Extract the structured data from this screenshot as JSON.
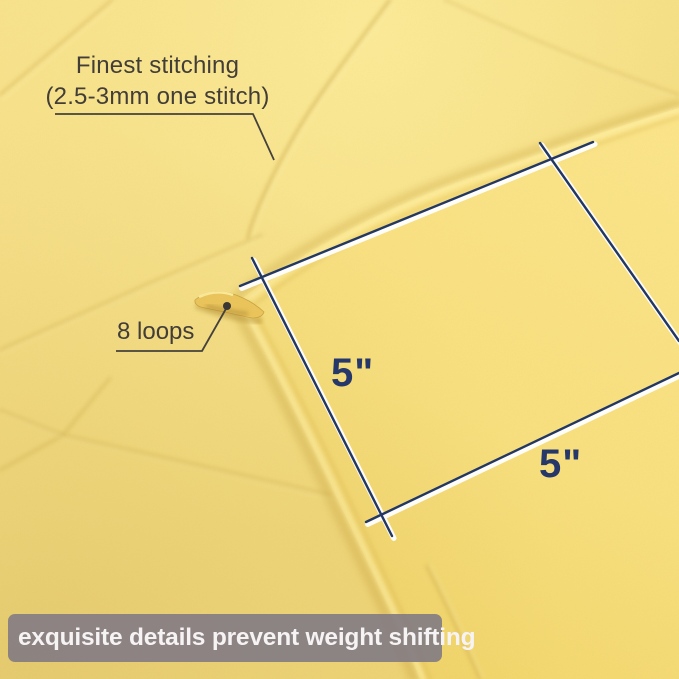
{
  "photo": {
    "subject": "yellow quilted weighted blanket corner close-up"
  },
  "annotations": {
    "stitching_line1": "Finest stitching",
    "stitching_line2": "(2.5-3mm one stitch)",
    "loops_label": "8 loops",
    "square_side_left": "5\"",
    "square_side_bottom": "5\""
  },
  "banner": {
    "text": "exquisite details prevent weight shifting"
  },
  "colors": {
    "fabric_yellow": "#f5dd80",
    "fabric_highlight": "#fbe88f",
    "fabric_shadow": "#dfbc58",
    "dimension_navy": "#233763",
    "annotation_charcoal": "#423d37",
    "banner_gray": "#867e83",
    "banner_text": "#f6f3f5"
  }
}
